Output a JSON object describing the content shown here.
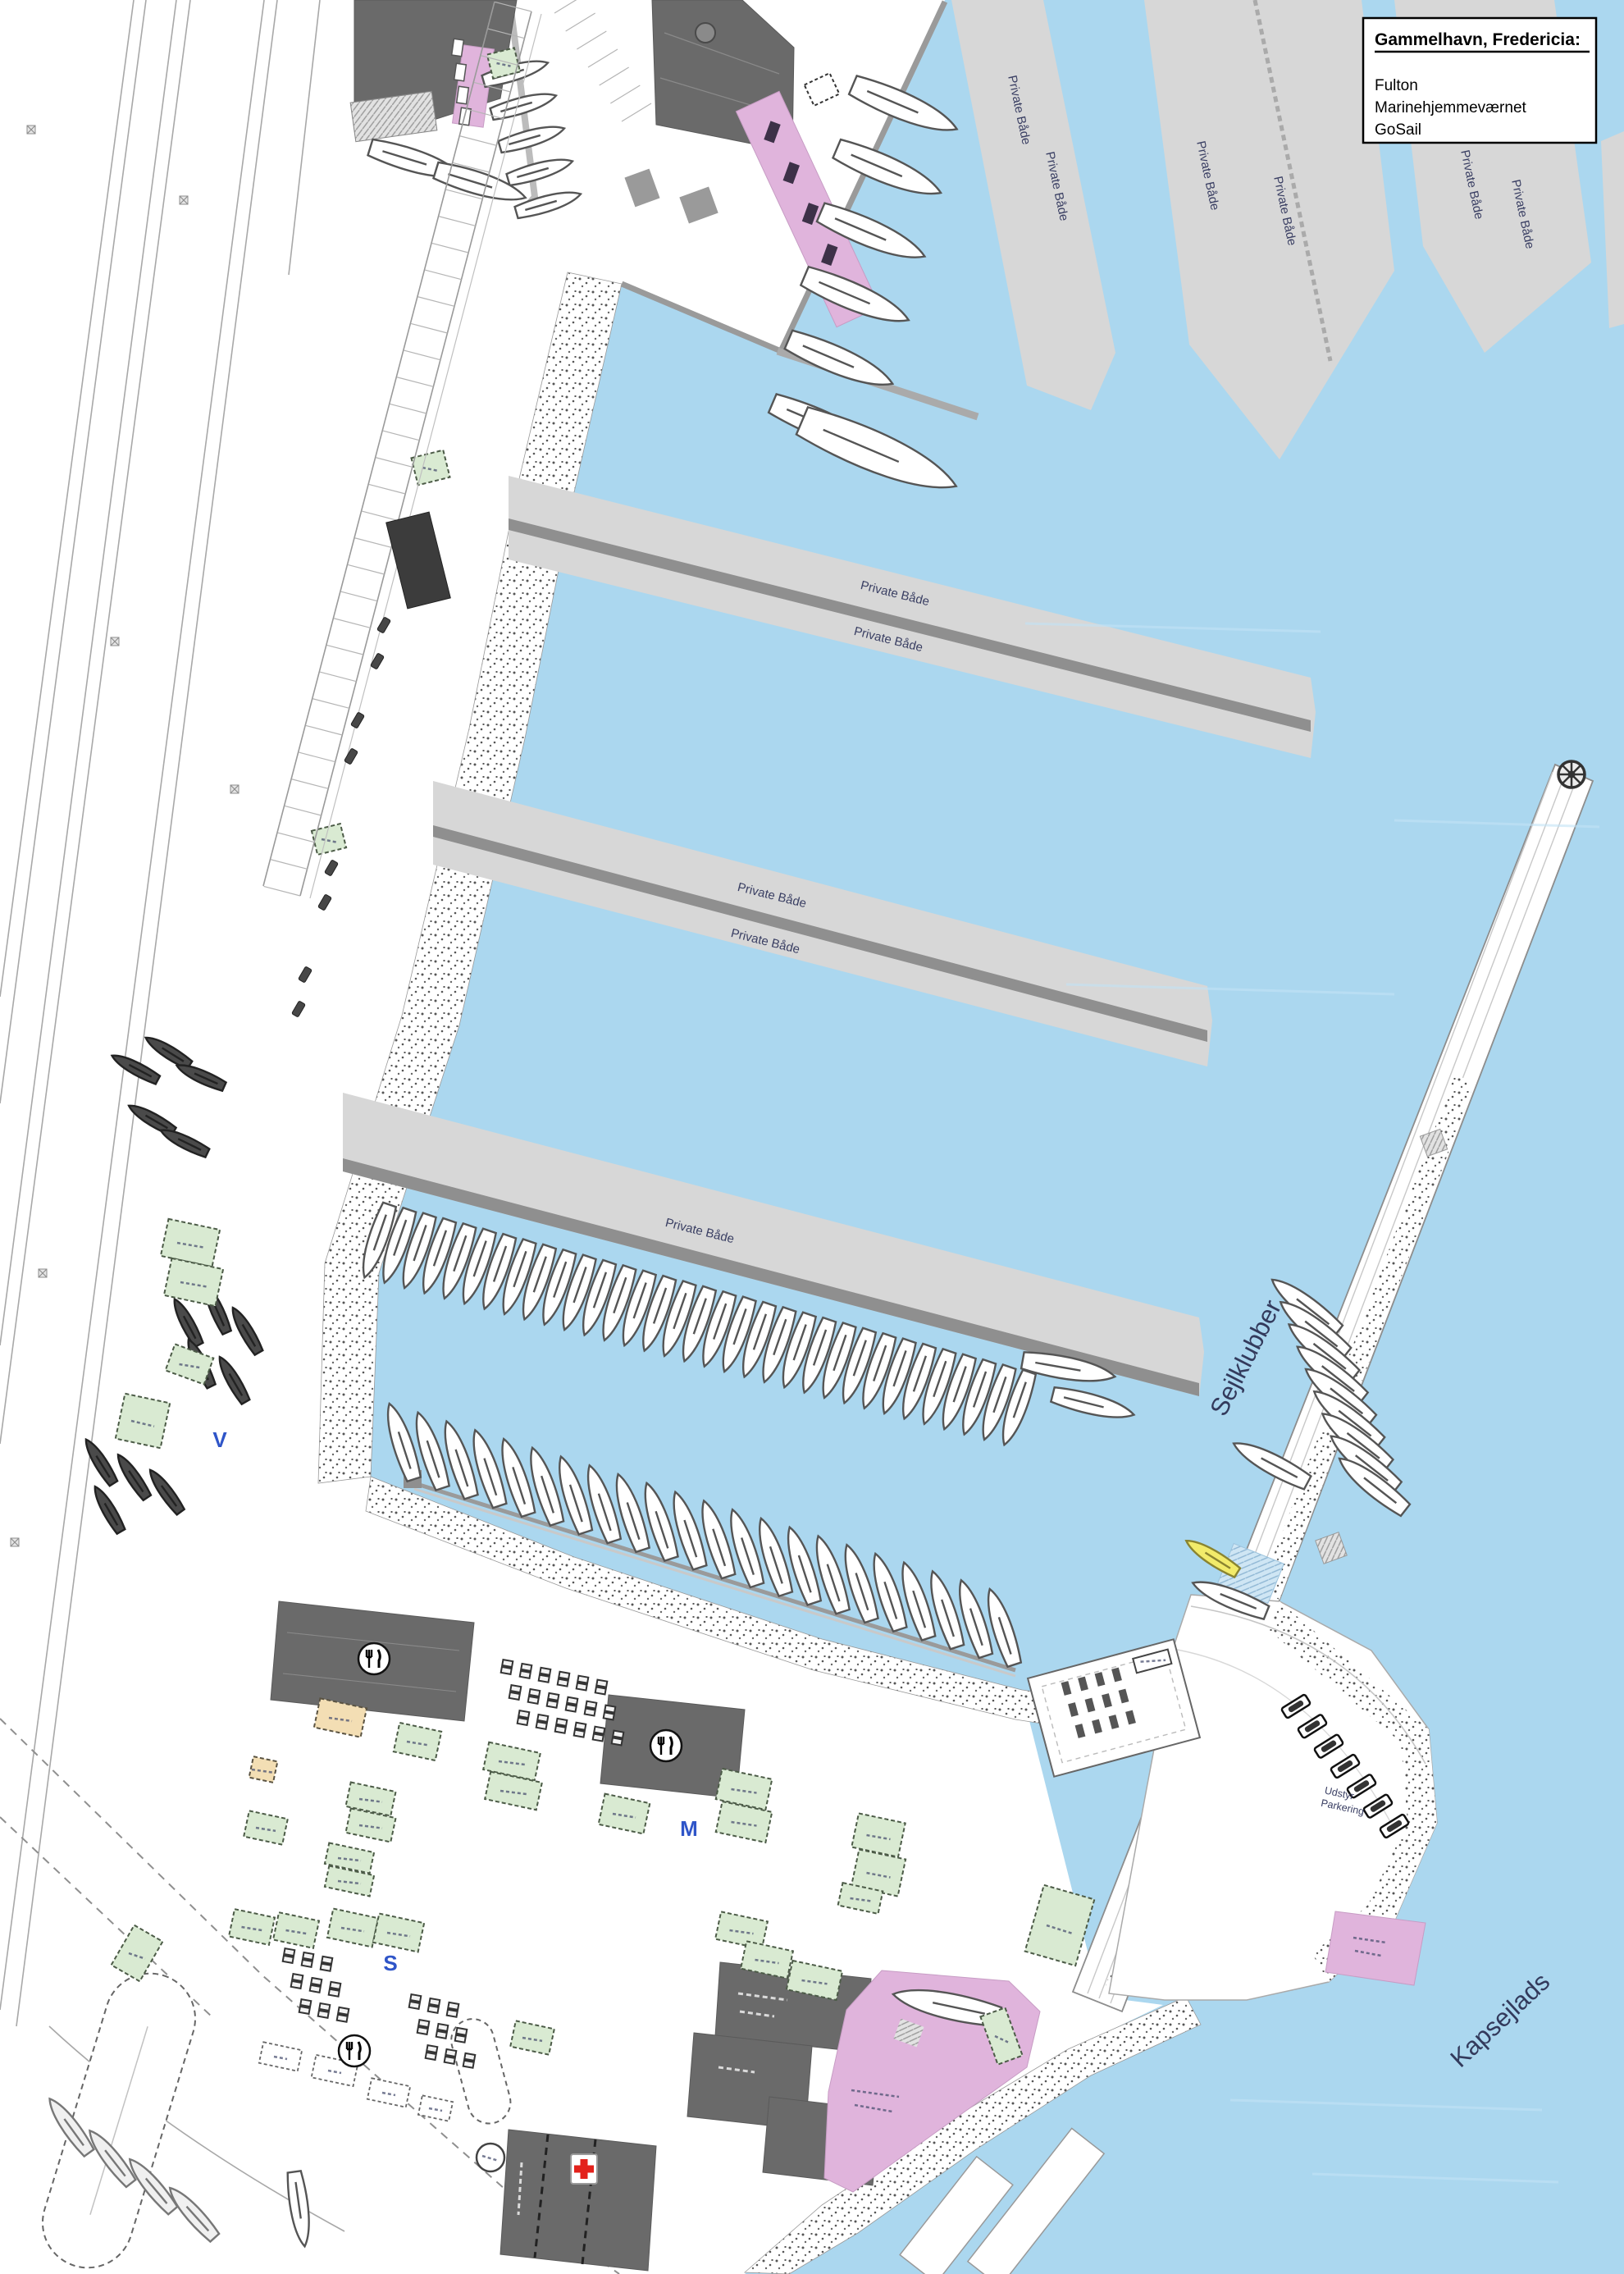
{
  "legend": {
    "title": "Gammelhavn, Fredericia:",
    "items": [
      "Fulton",
      "Marinehjemmeværnet",
      "GoSail"
    ]
  },
  "labels": {
    "private_boats": "Private Både",
    "sailing_clubs": "Sejlklubber",
    "regatta": "Kapsejlads",
    "equipment": "Udstyr",
    "parking": "Parkering",
    "zone_v": "V",
    "zone_s": "S",
    "zone_m": "M"
  },
  "icons": {
    "restaurant": "restaurant-icon",
    "first_aid": "first-aid-icon",
    "ship_wheel": "ship-wheel-icon",
    "roundabout": "roundabout-icon",
    "circular_structure": "circular-structure-icon"
  },
  "colors": {
    "water": "#abd7ef",
    "pier": "#d7d7d7",
    "pier_stripe": "#8f8f8f",
    "building_dark": "#6a6a6a",
    "building_green": "#d9ead2",
    "building_pink": "#e0b4dc",
    "building_beige": "#f3deb4",
    "boat_yellow": "#f2eb6a",
    "first_aid_red": "#e3211b",
    "zone_letter_blue": "#2f55c8",
    "map_label_dark": "#333a5c"
  }
}
